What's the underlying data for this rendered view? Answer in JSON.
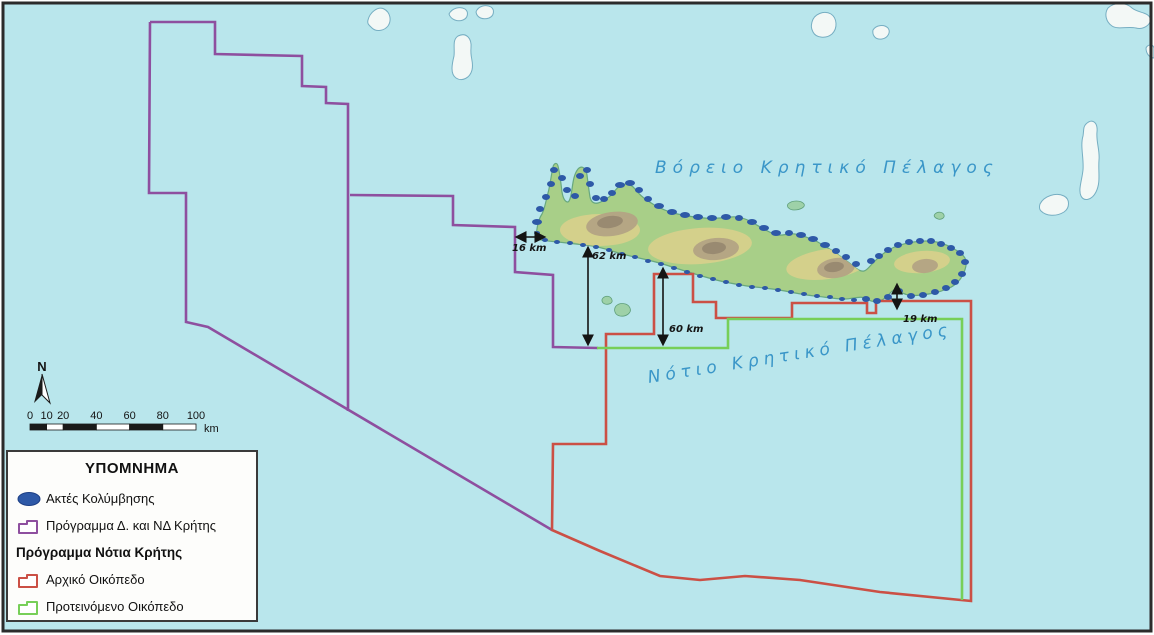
{
  "legend": {
    "title": "ΥΠΟΜΝΗΜΑ",
    "items": [
      {
        "label": "Ακτές Κολύμβησης",
        "icon": "swim-ellipse",
        "color": "#2e59a7",
        "bold": false
      },
      {
        "label": "Πρόγραμμα Δ. και ΝΔ Κρήτης",
        "icon": "block-outline",
        "color": "#8e4f9f",
        "bold": false
      },
      {
        "label": "Πρόγραμμα Νότια Κρήτης",
        "icon": "none",
        "color": "",
        "bold": true
      },
      {
        "label": "Αρχικό Οικόπεδο",
        "icon": "block-outline",
        "color": "#cb5045",
        "bold": false
      },
      {
        "label": "Προτεινόμενο Οικόπεδο",
        "icon": "block-outline",
        "color": "#77cf58",
        "bold": false
      }
    ]
  },
  "north": {
    "label": "N"
  },
  "scale_bar": {
    "tick_values": [
      0,
      10,
      20,
      40,
      60,
      80,
      100
    ],
    "unit": "km",
    "x0": 30,
    "y": 424,
    "px_per_km": 1.66,
    "height": 6
  },
  "map": {
    "sea_labels": [
      {
        "text": "Βόρειο Κρητικό Πέλαγος",
        "x": 655,
        "y": 158,
        "rot": -2
      },
      {
        "text": "Νότιο Κρητικό Πέλαγος",
        "x": 648,
        "y": 368,
        "rot": -9
      }
    ],
    "distance_markers": [
      {
        "label": "16 km",
        "x1": 517,
        "y1": 237,
        "x2": 544,
        "y2": 237,
        "lx": 512,
        "ly": 243
      },
      {
        "label": "62 km",
        "x1": 588,
        "y1": 248,
        "x2": 588,
        "y2": 344,
        "lx": 592,
        "ly": 251
      },
      {
        "label": "60 km",
        "x1": 663,
        "y1": 269,
        "x2": 663,
        "y2": 344,
        "lx": 669,
        "ly": 324
      },
      {
        "label": "19 km",
        "x1": 897,
        "y1": 285,
        "x2": 897,
        "y2": 308,
        "lx": 903,
        "ly": 314
      }
    ],
    "colors": {
      "sea": "#b9e6ec",
      "frame": "#2b2b2b",
      "purple": "#8e4f9f",
      "red": "#cb5045",
      "green": "#77cf58",
      "swim_dot": "#2e59a7",
      "sea_text": "#3a96c8",
      "land_base": "#a8cf88",
      "land_yellow": "#d8cf8c",
      "mountain": "#b3a384",
      "mountain_core": "#96876f",
      "coast": "#68a87f",
      "white_island": "#f3f8f6",
      "island_outline": "#76aec2",
      "islet_green": "#9ed1a8",
      "islet_outline": "#5f9f7a"
    },
    "geometry": {
      "purple_lines": [
        [
          [
            150,
            22
          ],
          [
            215,
            22
          ],
          [
            215,
            54
          ],
          [
            302,
            56
          ],
          [
            302,
            86
          ],
          [
            326,
            87
          ],
          [
            326,
            103
          ],
          [
            348,
            104
          ],
          [
            348,
            411
          ]
        ],
        [
          [
            150,
            22
          ],
          [
            149,
            193
          ],
          [
            186,
            193
          ],
          [
            186,
            322
          ],
          [
            208,
            327
          ],
          [
            552,
            530
          ]
        ],
        [
          [
            350,
            195
          ],
          [
            453,
            196
          ],
          [
            453,
            225
          ],
          [
            515,
            227
          ],
          [
            515,
            272
          ],
          [
            553,
            275
          ],
          [
            553,
            347
          ],
          [
            598,
            348
          ]
        ]
      ],
      "red_polygon": [
        [
          654,
          274
        ],
        [
          693,
          274
        ],
        [
          693,
          302
        ],
        [
          716,
          302
        ],
        [
          716,
          318
        ],
        [
          792,
          318
        ],
        [
          792,
          303
        ],
        [
          867,
          303
        ],
        [
          867,
          313
        ],
        [
          876,
          313
        ],
        [
          876,
          301
        ],
        [
          971,
          301
        ],
        [
          971,
          601
        ],
        [
          880,
          592
        ],
        [
          800,
          580
        ],
        [
          745,
          576
        ],
        [
          700,
          580
        ],
        [
          660,
          576
        ],
        [
          600,
          551
        ],
        [
          552,
          530
        ],
        [
          553,
          444
        ],
        [
          606,
          444
        ],
        [
          606,
          334
        ],
        [
          654,
          334
        ]
      ],
      "green_line": [
        [
          597,
          348
        ],
        [
          728,
          348
        ],
        [
          728,
          319
        ],
        [
          962,
          319
        ],
        [
          962,
          600
        ]
      ],
      "crete_path": "M536,236 C537,228 538,220 542,214 C545,208 546,200 548,193 C550,186 551,176 553,167 C554,163 557,162 558,166 C560,174 561,184 562,192 C563,198 565,202 568,202 C570,201 571,196 572,189 C573,182 574,174 578,169 C582,165 586,168 587,175 C588,183 589,191 590,197 C591,202 594,204 598,203 C602,202 605,199 609,197 C613,194 616,188 621,185 C626,183 631,184 635,189 C638,193 642,197 648,201 C654,205 661,209 670,212 C680,215 692,217 704,218 C713,219 722,218 731,217 C739,216 747,219 755,224 C762,228 770,233 777,235 C783,236 789,233 795,234 C802,235 809,238 816,241 C823,245 830,249 836,253 C841,257 847,261 852,265 C856,268 860,272 864,271 C868,270 871,264 876,260 C882,254 889,249 897,246 C906,243 916,241 926,241 C936,241 946,244 954,249 C960,252 965,256 966,261 C967,267 964,273 961,278 C957,284 951,288 944,290 C937,293 929,294 921,295 C913,296 905,296 898,290 C894,287 890,294 885,298 C880,302 873,303 867,299 C861,295 853,299 845,299 C835,299 825,297 815,296 C805,295 795,293 785,291 C775,289 765,288 755,287 C745,286 735,284 725,282 C715,280 705,277 695,274 C685,271 675,268 666,265 C657,262 648,260 639,258 C630,256 621,254 612,251 C603,248 594,246 585,245 C576,244 567,243 558,242 C550,241 542,241 538,239 Z",
      "yellow_zones": [
        [
          600,
          230,
          40,
          16,
          0
        ],
        [
          700,
          246,
          52,
          18,
          -4
        ],
        [
          828,
          264,
          42,
          15,
          -8
        ],
        [
          922,
          262,
          28,
          11,
          -5
        ]
      ],
      "mountains": [
        [
          612,
          224,
          26,
          12,
          -8
        ],
        [
          716,
          249,
          23,
          11,
          -5
        ],
        [
          836,
          268,
          19,
          10,
          -8
        ],
        [
          925,
          266,
          13,
          7,
          -5
        ]
      ],
      "mountain_cores": [
        [
          610,
          222,
          13,
          6,
          -8
        ],
        [
          714,
          248,
          12,
          6,
          -5
        ],
        [
          834,
          267,
          10,
          5,
          -8
        ]
      ],
      "white_islands": [
        "M368,20 C370,12 378,6 384,9 C390,12 392,20 388,26 C384,31 376,32 372,28 C369,25 367,24 368,20 Z",
        "M449,14 C452,8 460,6 465,9 C469,12 468,18 463,20 C458,22 451,20 449,14 Z",
        "M476,12 C478,6 486,4 491,7 C495,10 494,16 489,18 C483,20 477,18 476,12 Z",
        "M458,36 C466,32 472,38 471,48 C470,58 474,62 472,70 C470,78 462,82 456,78 C450,74 452,64 454,56 C455,48 452,40 458,36 Z",
        "M812,22 C814,14 824,10 831,14 C837,18 838,28 832,34 C826,39 816,38 813,32 C811,28 811,26 812,22 Z",
        "M873,30 C876,25 884,24 888,28 C891,32 888,38 882,39 C876,40 872,36 873,30 Z",
        "M1108,8 C1114,2 1126,2 1132,8 C1138,13 1148,12 1150,18 C1152,24 1144,30 1136,28 C1128,26 1118,30 1112,26 C1106,22 1104,14 1108,8 Z",
        "M1040,204 C1044,196 1056,192 1064,196 C1070,199 1070,208 1064,212 C1056,217 1046,216 1041,211 C1039,209 1039,207 1040,204 Z",
        "M1086,124 C1092,118 1098,122 1097,132 C1096,142 1100,150 1099,160 C1098,172 1101,182 1096,192 C1092,200 1084,202 1081,196 C1078,190 1082,180 1083,170 C1084,158 1080,146 1083,136 C1084,130 1083,127 1086,124 Z",
        "M1146,48 C1148,44 1153,44 1154,48 L1154,58 C1150,58 1146,54 1146,48 Z"
      ],
      "green_islets": [
        "M616,306 C620,302 628,303 630,308 C632,313 626,317 620,316 C615,315 613,310 616,306 Z",
        "M603,298 C606,295 611,296 612,300 C613,303 609,305 605,304 C602,303 601,300 603,298 Z",
        "M788,204 C792,200 801,200 804,204 C806,207 800,210 794,210 C790,210 786,207 788,204 Z",
        "M935,214 C938,211 943,212 944,215 C945,218 941,220 938,219 C935,218 933,216 935,214 Z"
      ],
      "swim_dots": [
        [
          537,
          222,
          5,
          3
        ],
        [
          540,
          209,
          4,
          3
        ],
        [
          546,
          197,
          4,
          3
        ],
        [
          551,
          184,
          4,
          3
        ],
        [
          554,
          170,
          4,
          3
        ],
        [
          562,
          178,
          4,
          3
        ],
        [
          567,
          190,
          4,
          3
        ],
        [
          575,
          196,
          4,
          3
        ],
        [
          580,
          176,
          4,
          3
        ],
        [
          587,
          170,
          4,
          3
        ],
        [
          590,
          184,
          4,
          3
        ],
        [
          596,
          198,
          4,
          3
        ],
        [
          604,
          199,
          4,
          3
        ],
        [
          612,
          193,
          4,
          3
        ],
        [
          620,
          185,
          5,
          3
        ],
        [
          630,
          183,
          5,
          3
        ],
        [
          639,
          190,
          4,
          3
        ],
        [
          648,
          199,
          4,
          3
        ],
        [
          659,
          206,
          5,
          3
        ],
        [
          672,
          212,
          5,
          3
        ],
        [
          685,
          215,
          5,
          3
        ],
        [
          698,
          217,
          5,
          3
        ],
        [
          712,
          218,
          5,
          3
        ],
        [
          726,
          217,
          5,
          3
        ],
        [
          739,
          218,
          4,
          3
        ],
        [
          752,
          222,
          5,
          3
        ],
        [
          764,
          228,
          5,
          3
        ],
        [
          776,
          233,
          5,
          3
        ],
        [
          789,
          233,
          4,
          3
        ],
        [
          801,
          235,
          5,
          3
        ],
        [
          813,
          239,
          5,
          3
        ],
        [
          825,
          245,
          5,
          3
        ],
        [
          836,
          251,
          4,
          3
        ],
        [
          846,
          257,
          4,
          3
        ],
        [
          856,
          264,
          4,
          3
        ],
        [
          871,
          261,
          4,
          3
        ],
        [
          879,
          256,
          4,
          3
        ],
        [
          888,
          250,
          4,
          3
        ],
        [
          898,
          245,
          4,
          3
        ],
        [
          909,
          242,
          4,
          3
        ],
        [
          920,
          241,
          4,
          3
        ],
        [
          931,
          241,
          4,
          3
        ],
        [
          941,
          244,
          4,
          3
        ],
        [
          951,
          248,
          4,
          3
        ],
        [
          960,
          253,
          4,
          3
        ],
        [
          965,
          262,
          4,
          3
        ],
        [
          962,
          274,
          4,
          3
        ],
        [
          955,
          282,
          4,
          3
        ],
        [
          946,
          288,
          4,
          3
        ],
        [
          935,
          292,
          4,
          3
        ],
        [
          923,
          295,
          4,
          3
        ],
        [
          911,
          296,
          4,
          3
        ],
        [
          899,
          291,
          4,
          3
        ],
        [
          888,
          297,
          4,
          3
        ],
        [
          877,
          301,
          4,
          3
        ],
        [
          866,
          299,
          4,
          3
        ],
        [
          854,
          300,
          3,
          2
        ],
        [
          842,
          299,
          3,
          2
        ],
        [
          830,
          297,
          3,
          2
        ],
        [
          817,
          296,
          3,
          2
        ],
        [
          804,
          294,
          3,
          2
        ],
        [
          791,
          292,
          3,
          2
        ],
        [
          778,
          290,
          3,
          2
        ],
        [
          765,
          288,
          3,
          2
        ],
        [
          752,
          287,
          3,
          2
        ],
        [
          739,
          285,
          3,
          2
        ],
        [
          726,
          282,
          3,
          2
        ],
        [
          713,
          279,
          3,
          2
        ],
        [
          700,
          276,
          3,
          2
        ],
        [
          687,
          272,
          3,
          2
        ],
        [
          674,
          268,
          3,
          2
        ],
        [
          661,
          264,
          3,
          2
        ],
        [
          648,
          261,
          3,
          2
        ],
        [
          635,
          257,
          3,
          2
        ],
        [
          622,
          254,
          3,
          2
        ],
        [
          609,
          250,
          3,
          2
        ],
        [
          596,
          247,
          3,
          2
        ],
        [
          583,
          245,
          3,
          2
        ],
        [
          570,
          243,
          3,
          2
        ],
        [
          557,
          242,
          3,
          2
        ],
        [
          545,
          240,
          3,
          2
        ],
        [
          537,
          233,
          3,
          2
        ]
      ]
    }
  }
}
